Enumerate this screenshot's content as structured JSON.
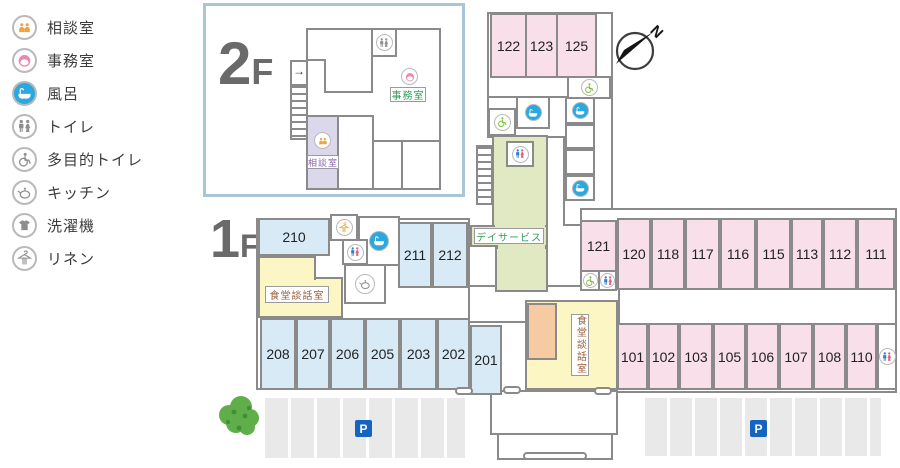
{
  "legend": {
    "items": [
      {
        "icon": "consult-icon",
        "label": "相談室"
      },
      {
        "icon": "office-icon",
        "label": "事務室"
      },
      {
        "icon": "bath-icon",
        "label": "風呂"
      },
      {
        "icon": "toilet-icon",
        "label": "トイレ"
      },
      {
        "icon": "accessible-toilet-icon",
        "label": "多目的トイレ"
      },
      {
        "icon": "kitchen-icon",
        "label": "キッチン"
      },
      {
        "icon": "laundry-icon",
        "label": "洗濯機"
      },
      {
        "icon": "linen-icon",
        "label": "リネン"
      }
    ]
  },
  "plan2f": {
    "floor_big": "2",
    "floor_small": "F",
    "office_label": "事務室",
    "consult_label": "相談室",
    "entry_arrow": "→"
  },
  "plan1f": {
    "floor_big": "1",
    "floor_small": "F",
    "north_rooms": [
      "122",
      "123",
      "125"
    ],
    "east_top_rooms": [
      "121",
      "120",
      "118",
      "117",
      "116",
      "115",
      "113",
      "112",
      "111"
    ],
    "east_bottom_rooms": [
      "101",
      "102",
      "103",
      "105",
      "106",
      "107",
      "108",
      "110"
    ],
    "west_top_rooms": [
      "210",
      "211",
      "212"
    ],
    "west_bottom_rooms": [
      "208",
      "207",
      "206",
      "205",
      "203",
      "202",
      "201"
    ],
    "day_service_label": "デイサービス",
    "dining_room_label": "食堂談話室",
    "dining_room2_label": "食堂談話室",
    "parking_label": "P",
    "parking2_label": "P"
  },
  "compass": {
    "north_label": "N"
  },
  "colors": {
    "pink": "#f9dfe9",
    "blue": "#d7eaf5",
    "yellow": "#fcf6c5",
    "green": "#e0e9c1",
    "orange": "#f6cba3",
    "purple": "#dcd8ec",
    "wall": "#8a8a8a",
    "parking": "#e9e9e9",
    "bath-blue": "#2aa9e0",
    "icon-green": "#7fbf3f",
    "icon-orange": "#f0a23c",
    "icon-pink": "#ef86b0",
    "man-blue": "#2f7fd0",
    "woman-red": "#e4607e",
    "label-green": "#2f9e55",
    "label-purple": "#8a63ad",
    "label-brown": "#96603c",
    "p-blue": "#1565c0",
    "floor-gray": "#6a6a6a",
    "inset-border": "#a9c6d8",
    "tree-green": "#5fae4a"
  }
}
